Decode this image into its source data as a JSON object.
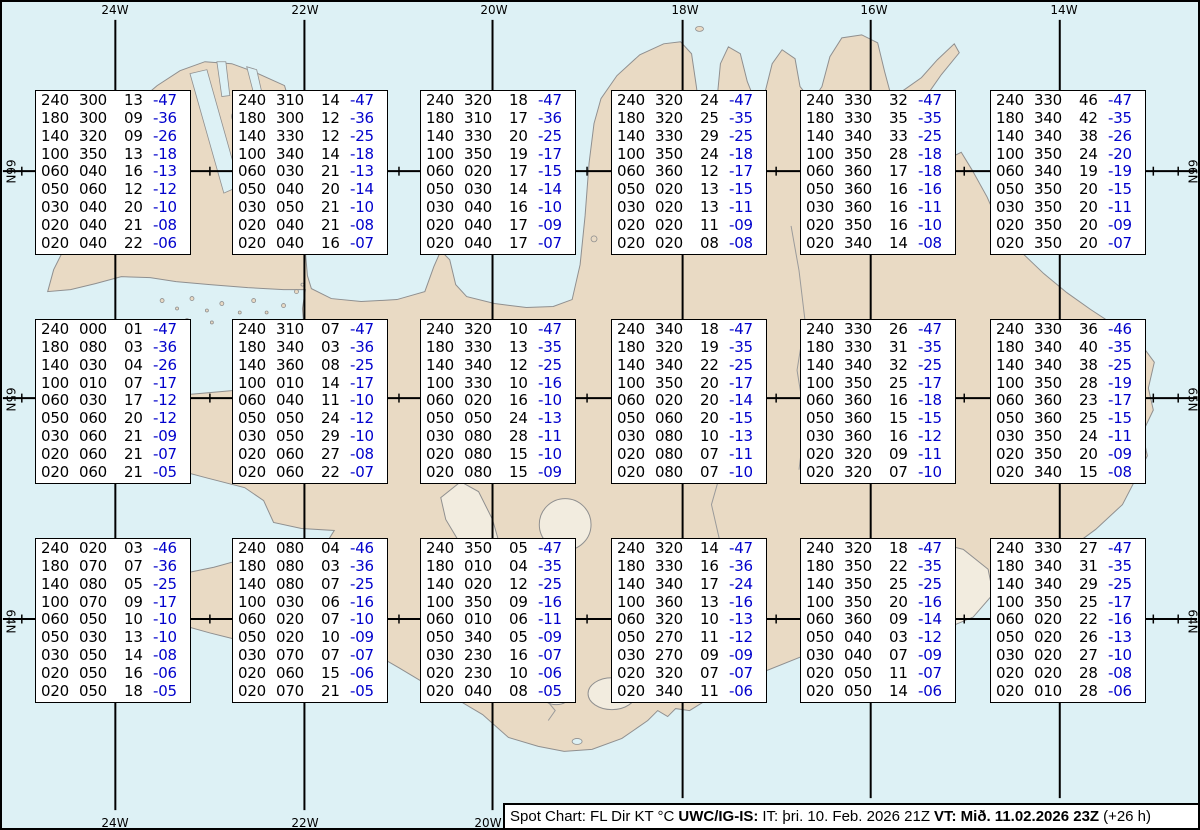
{
  "grid": {
    "meridian_labels": [
      "24W",
      "22W",
      "20W",
      "18W",
      "16W",
      "14W"
    ],
    "bottom_meridian_labels": [
      "24W",
      "22W",
      "20W"
    ],
    "parallel_labels": [
      "66N",
      "65N",
      "64N"
    ]
  },
  "boxes": [
    {
      "rows": [
        [
          "240",
          "300",
          "13",
          "-47"
        ],
        [
          "180",
          "300",
          "09",
          "-36"
        ],
        [
          "140",
          "320",
          "09",
          "-26"
        ],
        [
          "100",
          "350",
          "13",
          "-18"
        ],
        [
          "060",
          "040",
          "16",
          "-13"
        ],
        [
          "050",
          "060",
          "12",
          "-12"
        ],
        [
          "030",
          "040",
          "20",
          "-10"
        ],
        [
          "020",
          "040",
          "21",
          "-08"
        ],
        [
          "020",
          "040",
          "22",
          "-06"
        ]
      ]
    },
    {
      "rows": [
        [
          "240",
          "310",
          "14",
          "-47"
        ],
        [
          "180",
          "300",
          "12",
          "-36"
        ],
        [
          "140",
          "330",
          "12",
          "-25"
        ],
        [
          "100",
          "340",
          "14",
          "-18"
        ],
        [
          "060",
          "030",
          "21",
          "-13"
        ],
        [
          "050",
          "040",
          "20",
          "-14"
        ],
        [
          "030",
          "050",
          "21",
          "-10"
        ],
        [
          "020",
          "040",
          "21",
          "-08"
        ],
        [
          "020",
          "040",
          "16",
          "-07"
        ]
      ]
    },
    {
      "rows": [
        [
          "240",
          "320",
          "18",
          "-47"
        ],
        [
          "180",
          "310",
          "17",
          "-36"
        ],
        [
          "140",
          "330",
          "20",
          "-25"
        ],
        [
          "100",
          "350",
          "19",
          "-17"
        ],
        [
          "060",
          "020",
          "17",
          "-15"
        ],
        [
          "050",
          "030",
          "14",
          "-14"
        ],
        [
          "030",
          "040",
          "16",
          "-10"
        ],
        [
          "020",
          "040",
          "17",
          "-09"
        ],
        [
          "020",
          "040",
          "17",
          "-07"
        ]
      ]
    },
    {
      "rows": [
        [
          "240",
          "320",
          "24",
          "-47"
        ],
        [
          "180",
          "320",
          "25",
          "-35"
        ],
        [
          "140",
          "330",
          "29",
          "-25"
        ],
        [
          "100",
          "350",
          "24",
          "-18"
        ],
        [
          "060",
          "360",
          "12",
          "-17"
        ],
        [
          "050",
          "020",
          "13",
          "-15"
        ],
        [
          "030",
          "020",
          "13",
          "-11"
        ],
        [
          "020",
          "020",
          "11",
          "-09"
        ],
        [
          "020",
          "020",
          "08",
          "-08"
        ]
      ]
    },
    {
      "rows": [
        [
          "240",
          "330",
          "32",
          "-47"
        ],
        [
          "180",
          "330",
          "35",
          "-35"
        ],
        [
          "140",
          "340",
          "33",
          "-25"
        ],
        [
          "100",
          "350",
          "28",
          "-18"
        ],
        [
          "060",
          "360",
          "17",
          "-18"
        ],
        [
          "050",
          "360",
          "16",
          "-16"
        ],
        [
          "030",
          "360",
          "16",
          "-11"
        ],
        [
          "020",
          "350",
          "16",
          "-10"
        ],
        [
          "020",
          "340",
          "14",
          "-08"
        ]
      ]
    },
    {
      "rows": [
        [
          "240",
          "330",
          "46",
          "-47"
        ],
        [
          "180",
          "340",
          "42",
          "-35"
        ],
        [
          "140",
          "340",
          "38",
          "-26"
        ],
        [
          "100",
          "350",
          "24",
          "-20"
        ],
        [
          "060",
          "340",
          "19",
          "-19"
        ],
        [
          "050",
          "350",
          "20",
          "-15"
        ],
        [
          "030",
          "350",
          "20",
          "-11"
        ],
        [
          "020",
          "350",
          "20",
          "-09"
        ],
        [
          "020",
          "350",
          "20",
          "-07"
        ]
      ]
    },
    {
      "rows": [
        [
          "240",
          "000",
          "01",
          "-47"
        ],
        [
          "180",
          "080",
          "03",
          "-36"
        ],
        [
          "140",
          "030",
          "04",
          "-26"
        ],
        [
          "100",
          "010",
          "07",
          "-17"
        ],
        [
          "060",
          "030",
          "17",
          "-12"
        ],
        [
          "050",
          "060",
          "20",
          "-12"
        ],
        [
          "030",
          "060",
          "21",
          "-09"
        ],
        [
          "020",
          "060",
          "21",
          "-07"
        ],
        [
          "020",
          "060",
          "21",
          "-05"
        ]
      ]
    },
    {
      "rows": [
        [
          "240",
          "310",
          "07",
          "-47"
        ],
        [
          "180",
          "340",
          "03",
          "-36"
        ],
        [
          "140",
          "360",
          "08",
          "-25"
        ],
        [
          "100",
          "010",
          "14",
          "-17"
        ],
        [
          "060",
          "040",
          "11",
          "-10"
        ],
        [
          "050",
          "050",
          "24",
          "-12"
        ],
        [
          "030",
          "050",
          "29",
          "-10"
        ],
        [
          "020",
          "060",
          "27",
          "-08"
        ],
        [
          "020",
          "060",
          "22",
          "-07"
        ]
      ]
    },
    {
      "rows": [
        [
          "240",
          "320",
          "10",
          "-47"
        ],
        [
          "180",
          "330",
          "13",
          "-35"
        ],
        [
          "140",
          "340",
          "12",
          "-25"
        ],
        [
          "100",
          "330",
          "10",
          "-16"
        ],
        [
          "060",
          "020",
          "16",
          "-10"
        ],
        [
          "050",
          "050",
          "24",
          "-13"
        ],
        [
          "030",
          "080",
          "28",
          "-11"
        ],
        [
          "020",
          "080",
          "15",
          "-10"
        ],
        [
          "020",
          "080",
          "15",
          "-09"
        ]
      ]
    },
    {
      "rows": [
        [
          "240",
          "340",
          "18",
          "-47"
        ],
        [
          "180",
          "320",
          "19",
          "-35"
        ],
        [
          "140",
          "340",
          "22",
          "-25"
        ],
        [
          "100",
          "350",
          "20",
          "-17"
        ],
        [
          "060",
          "020",
          "20",
          "-14"
        ],
        [
          "050",
          "060",
          "20",
          "-15"
        ],
        [
          "030",
          "080",
          "10",
          "-13"
        ],
        [
          "020",
          "080",
          "07",
          "-11"
        ],
        [
          "020",
          "080",
          "07",
          "-10"
        ]
      ]
    },
    {
      "rows": [
        [
          "240",
          "330",
          "26",
          "-47"
        ],
        [
          "180",
          "330",
          "31",
          "-35"
        ],
        [
          "140",
          "340",
          "32",
          "-25"
        ],
        [
          "100",
          "350",
          "25",
          "-17"
        ],
        [
          "060",
          "360",
          "16",
          "-18"
        ],
        [
          "050",
          "360",
          "15",
          "-15"
        ],
        [
          "030",
          "360",
          "16",
          "-12"
        ],
        [
          "020",
          "320",
          "09",
          "-11"
        ],
        [
          "020",
          "320",
          "07",
          "-10"
        ]
      ]
    },
    {
      "rows": [
        [
          "240",
          "330",
          "36",
          "-46"
        ],
        [
          "180",
          "340",
          "40",
          "-35"
        ],
        [
          "140",
          "340",
          "38",
          "-25"
        ],
        [
          "100",
          "350",
          "28",
          "-19"
        ],
        [
          "060",
          "360",
          "23",
          "-17"
        ],
        [
          "050",
          "360",
          "25",
          "-15"
        ],
        [
          "030",
          "350",
          "24",
          "-11"
        ],
        [
          "020",
          "350",
          "20",
          "-09"
        ],
        [
          "020",
          "340",
          "15",
          "-08"
        ]
      ]
    },
    {
      "rows": [
        [
          "240",
          "020",
          "03",
          "-46"
        ],
        [
          "180",
          "070",
          "07",
          "-36"
        ],
        [
          "140",
          "080",
          "05",
          "-25"
        ],
        [
          "100",
          "070",
          "09",
          "-17"
        ],
        [
          "060",
          "050",
          "10",
          "-10"
        ],
        [
          "050",
          "030",
          "13",
          "-10"
        ],
        [
          "030",
          "050",
          "14",
          "-08"
        ],
        [
          "020",
          "050",
          "16",
          "-06"
        ],
        [
          "020",
          "050",
          "18",
          "-05"
        ]
      ]
    },
    {
      "rows": [
        [
          "240",
          "080",
          "04",
          "-46"
        ],
        [
          "180",
          "080",
          "03",
          "-36"
        ],
        [
          "140",
          "080",
          "07",
          "-25"
        ],
        [
          "100",
          "030",
          "06",
          "-16"
        ],
        [
          "060",
          "020",
          "07",
          "-10"
        ],
        [
          "050",
          "020",
          "10",
          "-09"
        ],
        [
          "030",
          "070",
          "07",
          "-07"
        ],
        [
          "020",
          "060",
          "15",
          "-06"
        ],
        [
          "020",
          "070",
          "21",
          "-05"
        ]
      ]
    },
    {
      "rows": [
        [
          "240",
          "350",
          "05",
          "-47"
        ],
        [
          "180",
          "010",
          "04",
          "-35"
        ],
        [
          "140",
          "020",
          "12",
          "-25"
        ],
        [
          "100",
          "350",
          "09",
          "-16"
        ],
        [
          "060",
          "010",
          "06",
          "-11"
        ],
        [
          "050",
          "340",
          "05",
          "-09"
        ],
        [
          "030",
          "230",
          "16",
          "-07"
        ],
        [
          "020",
          "230",
          "10",
          "-06"
        ],
        [
          "020",
          "040",
          "08",
          "-05"
        ]
      ]
    },
    {
      "rows": [
        [
          "240",
          "320",
          "14",
          "-47"
        ],
        [
          "180",
          "330",
          "16",
          "-36"
        ],
        [
          "140",
          "340",
          "17",
          "-24"
        ],
        [
          "100",
          "360",
          "13",
          "-16"
        ],
        [
          "060",
          "320",
          "10",
          "-13"
        ],
        [
          "050",
          "270",
          "11",
          "-12"
        ],
        [
          "030",
          "270",
          "09",
          "-09"
        ],
        [
          "020",
          "320",
          "07",
          "-07"
        ],
        [
          "020",
          "340",
          "11",
          "-06"
        ]
      ]
    },
    {
      "rows": [
        [
          "240",
          "320",
          "18",
          "-47"
        ],
        [
          "180",
          "350",
          "22",
          "-35"
        ],
        [
          "140",
          "350",
          "25",
          "-25"
        ],
        [
          "100",
          "350",
          "20",
          "-16"
        ],
        [
          "060",
          "360",
          "09",
          "-14"
        ],
        [
          "050",
          "040",
          "03",
          "-12"
        ],
        [
          "030",
          "040",
          "07",
          "-09"
        ],
        [
          "020",
          "050",
          "11",
          "-07"
        ],
        [
          "020",
          "050",
          "14",
          "-06"
        ]
      ]
    },
    {
      "rows": [
        [
          "240",
          "330",
          "27",
          "-47"
        ],
        [
          "180",
          "340",
          "31",
          "-35"
        ],
        [
          "140",
          "340",
          "29",
          "-25"
        ],
        [
          "100",
          "350",
          "25",
          "-17"
        ],
        [
          "060",
          "020",
          "22",
          "-16"
        ],
        [
          "050",
          "020",
          "26",
          "-13"
        ],
        [
          "030",
          "020",
          "27",
          "-10"
        ],
        [
          "020",
          "020",
          "28",
          "-08"
        ],
        [
          "020",
          "010",
          "28",
          "-06"
        ]
      ]
    }
  ],
  "footer": {
    "label": "Spot Chart: FL Dir KT °C",
    "source": "UWC/IG-IS:",
    "issue": "IT: þri. 10. Feb. 2026 21Z",
    "valid": "VT: Mið. 11.02.2026 23Z",
    "lead": "(+26 h)"
  },
  "colors": {
    "ocean": "#ddf1f5",
    "land": "#e9dac4",
    "coast": "#8f8f8f",
    "temp_text": "#0000cc"
  }
}
